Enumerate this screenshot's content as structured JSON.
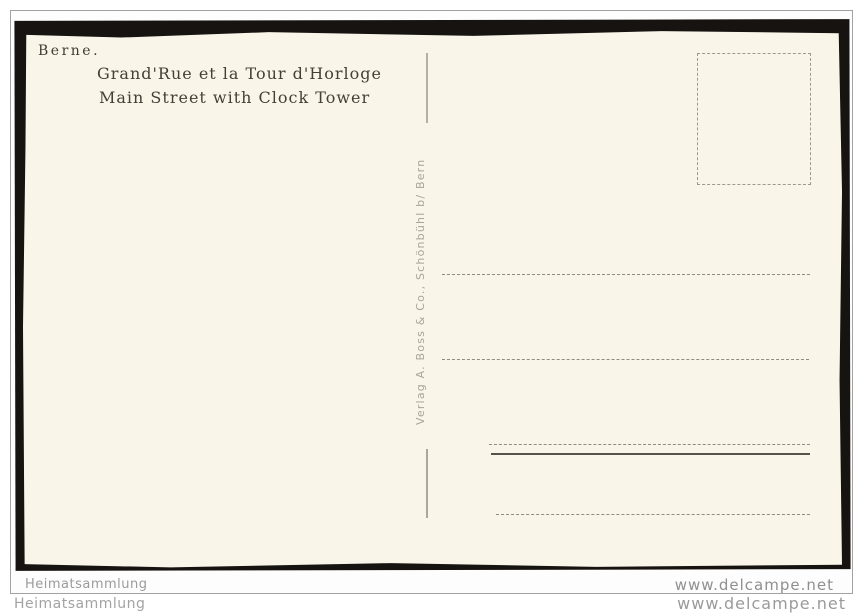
{
  "scan": {
    "card_background": "#f9f6e9",
    "card_edge_color": "#161310",
    "frame_border_color": "#a2a2a2"
  },
  "postcard": {
    "city": "Berne.",
    "title_fr": "Grand'Rue et la Tour d'Horloge",
    "title_en": "Main Street with Clock Tower",
    "publisher_imprint": "Verlag A. Boss & Co., Schönbühl b/ Bern"
  },
  "watermarks": {
    "inner_left": "Heimatsammlung",
    "inner_right": "www.delcampe.net",
    "outer_left": "Heimatsammlung",
    "outer_right": "www.delcampe.net"
  }
}
